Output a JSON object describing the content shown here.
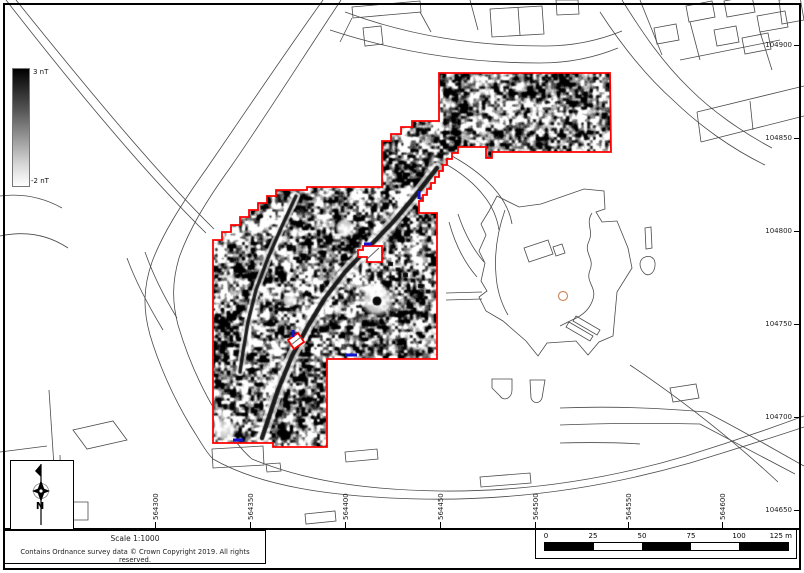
{
  "colorbar": {
    "max": "3 nT",
    "min": "-2 nT"
  },
  "north": {
    "label": "N"
  },
  "footer": {
    "scale": "Scale 1:1000",
    "copyright": "Contains Ordnance survey data © Crown Copyright 2019. All rights reserved."
  },
  "scalebar": {
    "labels": [
      "0",
      "25",
      "50",
      "75",
      "100"
    ],
    "end": "125 m"
  },
  "grid": {
    "northings": [
      "104900",
      "104850",
      "104800",
      "104750",
      "104700",
      "104650"
    ],
    "eastings": [
      "564300",
      "564350",
      "564400",
      "564450",
      "564500",
      "564550",
      "564600"
    ]
  },
  "colors": {
    "survey_outline": "#ff0000",
    "annotation_blue": "#1414cc",
    "feature_circle": "#cd8c63",
    "basemap_line": "#4a4a4a"
  }
}
